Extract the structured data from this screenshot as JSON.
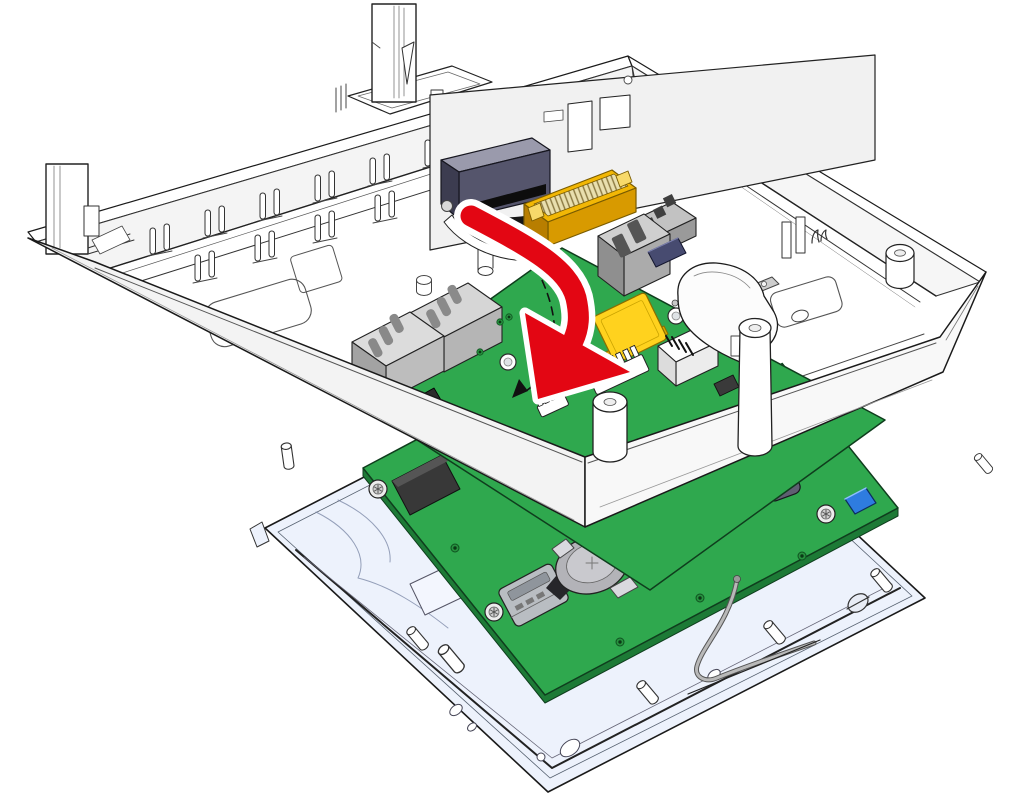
{
  "canvas": {
    "width": 1024,
    "height": 798,
    "background": "#ffffff"
  },
  "colors": {
    "outline": "#1a1a1a",
    "plastic_white": "#ffffff",
    "plastic_shade": "#f4f4f4",
    "band_left": "#f3f3f3",
    "band_right": "#f8f8f8",
    "frame_blue_white": "#edf2fc",
    "pcb_green": "#2fa84e",
    "pcb_edge_green": "#1d7a36",
    "via_green": "#27923f",
    "connector_dark_top": "#9a9aac",
    "connector_dark_front": "#55556c",
    "connector_dark_side": "#3c3c50",
    "ffc_yellow": "#f2b705",
    "ffc_yellow_front": "#d89a00",
    "buzzer_yellow": "#ffd21e",
    "relay_white": "#fdfdfd",
    "metal_light": "#cfcfcf",
    "metal_mid": "#ababab",
    "metal_dark": "#8f8f8f",
    "ic_navy": "#474b70",
    "component_black": "#383838",
    "component_blue": "#2e7ce0",
    "capacitor_slate": "#5f5f72",
    "battery_gray": "#b3b3b8",
    "wire_gray": "#b9b9b9",
    "wire_outline": "#555555",
    "arrow_red": "#e30613",
    "arrow_casing": "#ffffff",
    "guide_black": "#111111"
  },
  "arrow": {
    "kind": "rotation-insert-arrow",
    "direction": "down-left",
    "color": "#e30613",
    "outline": "#ffffff"
  },
  "guide": {
    "kind": "dashed-motion-arc",
    "color": "#111111",
    "dash": "8 6"
  },
  "parts": [
    {
      "name": "rear-enclosure-shell",
      "color": "#ffffff"
    },
    {
      "name": "snap-clip-tab-top",
      "color": "#ffffff"
    },
    {
      "name": "snap-clip-tab-left",
      "color": "#ffffff"
    },
    {
      "name": "rib-pin-pair",
      "count": 12
    },
    {
      "name": "board-to-board-connector",
      "color": "#55556c"
    },
    {
      "name": "ffc-connector",
      "color": "#f2b705"
    },
    {
      "name": "ribbon-cable",
      "color": "#151515"
    },
    {
      "name": "main-pcb",
      "color": "#2fa84e"
    },
    {
      "name": "rj45-jack",
      "count": 2,
      "color": "#bdbdbd"
    },
    {
      "name": "shielded-connector",
      "color": "#ababab"
    },
    {
      "name": "terminal-block",
      "color": "#c2c2c2"
    },
    {
      "name": "ic-chip",
      "color": "#474b70"
    },
    {
      "name": "piezo-buzzer",
      "color": "#ffd21e"
    },
    {
      "name": "relay-with-marking",
      "color": "#fdfdfd"
    },
    {
      "name": "fuse",
      "color": "#f6f6f6"
    },
    {
      "name": "protective-hood",
      "color": "#fcfcfc"
    },
    {
      "name": "standoff-pillar",
      "count": 2
    },
    {
      "name": "display-frame",
      "color": "#edf2fc"
    },
    {
      "name": "display-pcb",
      "color": "#2fa84e"
    },
    {
      "name": "coin-cell-holder",
      "color": "#b3b3b8"
    },
    {
      "name": "microsd-slot",
      "color": "#b9bdc2"
    },
    {
      "name": "electrolytic-capacitor",
      "color": "#5f5f72"
    },
    {
      "name": "blue-component",
      "color": "#2e7ce0"
    },
    {
      "name": "torx-screw",
      "count": 5
    },
    {
      "name": "frame-pin",
      "count": 7
    },
    {
      "name": "antenna-wire",
      "color": "#b9b9b9"
    }
  ]
}
